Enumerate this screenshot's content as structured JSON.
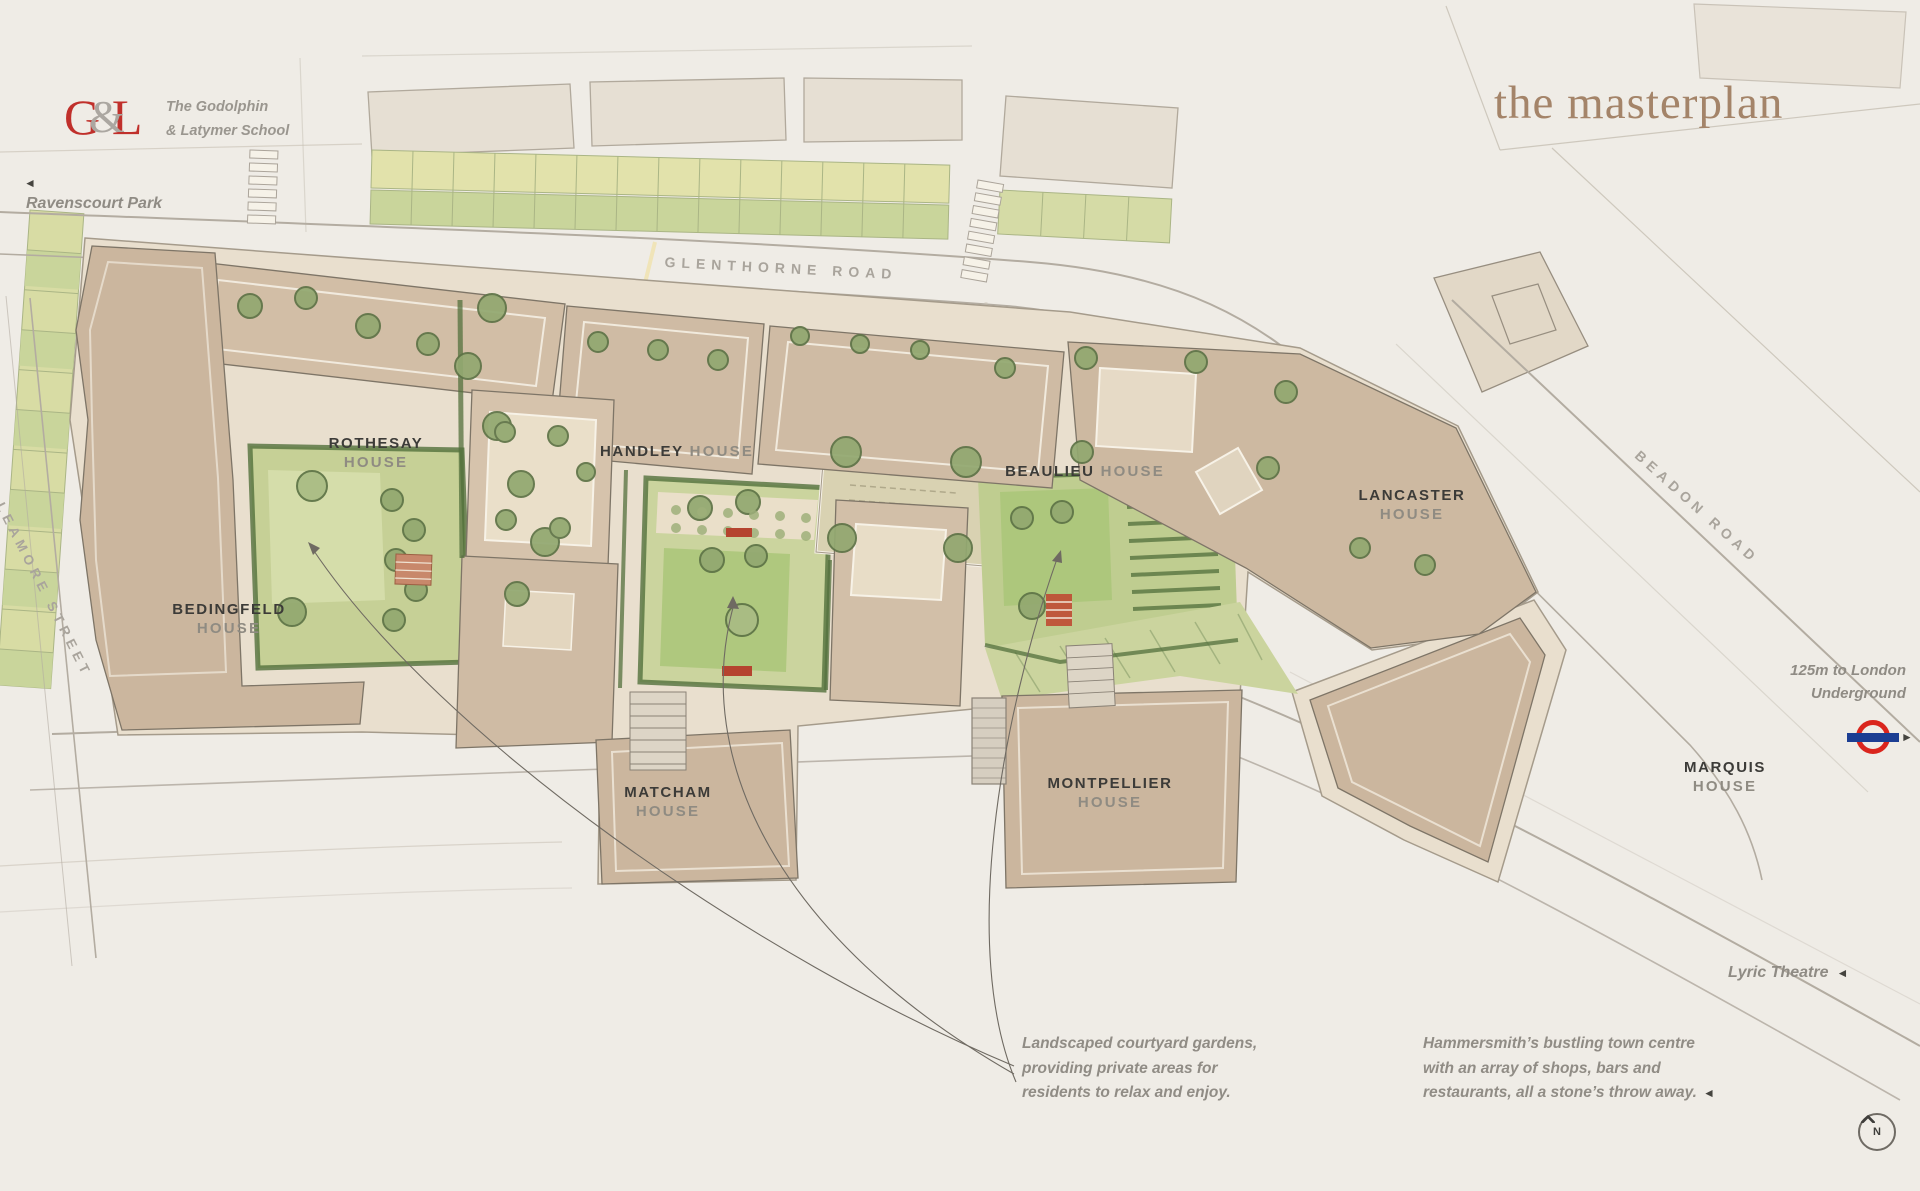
{
  "brand": {
    "letter_g": "G",
    "ampersand": "&",
    "letter_l": "L",
    "school_line1": "The Godolphin",
    "school_line2": "& Latymer School"
  },
  "title": {
    "text": "the masterplan"
  },
  "roads": {
    "glenthorne": "GLENTHORNE ROAD",
    "leamore": "LEAMORE STREET",
    "beadon": "BEADON ROAD"
  },
  "landmarks": {
    "ravenscourt_park": {
      "arrow": "◄",
      "label": "Ravenscourt Park"
    },
    "underground": {
      "line1": "125m to London",
      "line2": "Underground",
      "arrow": "►"
    },
    "lyric_theatre": {
      "label": "Lyric Theatre",
      "arrow": "◄"
    }
  },
  "houses": [
    {
      "name": "ROTHESAY",
      "type": "HOUSE"
    },
    {
      "name": "HANDLEY",
      "type": "HOUSE"
    },
    {
      "name": "BEAULIEU",
      "type": "HOUSE"
    },
    {
      "name": "LANCASTER",
      "type": "HOUSE"
    },
    {
      "name": "BEDINGFELD",
      "type": "HOUSE"
    },
    {
      "name": "MATCHAM",
      "type": "HOUSE"
    },
    {
      "name": "MONTPELLIER",
      "type": "HOUSE"
    },
    {
      "name": "MARQUIS",
      "type": "HOUSE"
    }
  ],
  "annotations": {
    "courtyards": {
      "line1": "Landscaped courtyard gardens,",
      "line2": "providing private areas for",
      "line3": "residents to relax and enjoy."
    },
    "town_centre": {
      "line1": "Hammersmith’s bustling town centre",
      "line2": "with an array of shops, bars and",
      "line3": "restaurants, all a stone’s throw away.",
      "arrow": "◄"
    }
  },
  "compass": {
    "letter": "N"
  },
  "colors": {
    "background": "#EFECE6",
    "brand_red": "#C0302B",
    "title_brown": "#A48469",
    "roundel_red": "#DA251D",
    "roundel_blue": "#1C3E93",
    "building_tan": "#CFBBA4",
    "lawn_green": "#B4C983",
    "hedge_green": "#53703C",
    "label_dark": "#3C3B38",
    "label_gray": "#8F8B84"
  }
}
